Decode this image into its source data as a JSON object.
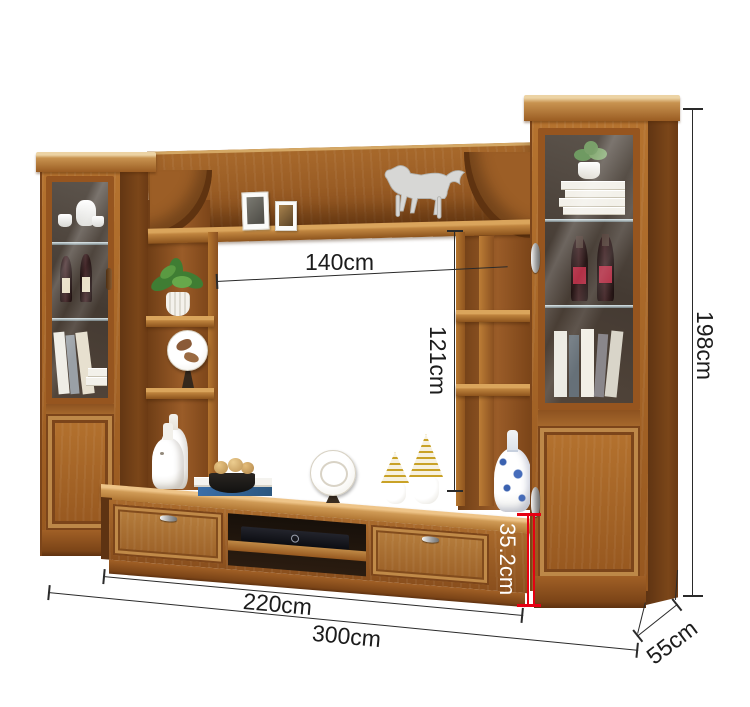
{
  "page": {
    "background": "#ffffff"
  },
  "style": {
    "dimension_line_color": "#2a2a2a",
    "highlight_color": "#e60012",
    "highlight_text_color": "#ffffff",
    "wood_color": "#a5682c"
  },
  "dimensions": {
    "tv_opening_width": "140cm",
    "tv_opening_height": "121cm",
    "overall_height": "198cm",
    "tv_stand_height": "35.2cm",
    "tv_stand_width": "220cm",
    "overall_width": "300cm",
    "depth": "55cm"
  },
  "product": {
    "type": "wood-tv-wall-unit",
    "sections": [
      "left-display-cabinet",
      "left-open-shelves",
      "top-bridge-shelf",
      "tv-stand",
      "right-open-shelves",
      "right-display-cabinet"
    ],
    "decor": [
      "photo-frames",
      "silver-horse-figurine",
      "tea-set",
      "wine-bottles",
      "books",
      "green-plant",
      "decorative-plates",
      "white-vases",
      "blue-porcelain-vase",
      "fruit-bowl",
      "gold-wire-ornaments",
      "succulent",
      "black-media-player"
    ]
  }
}
